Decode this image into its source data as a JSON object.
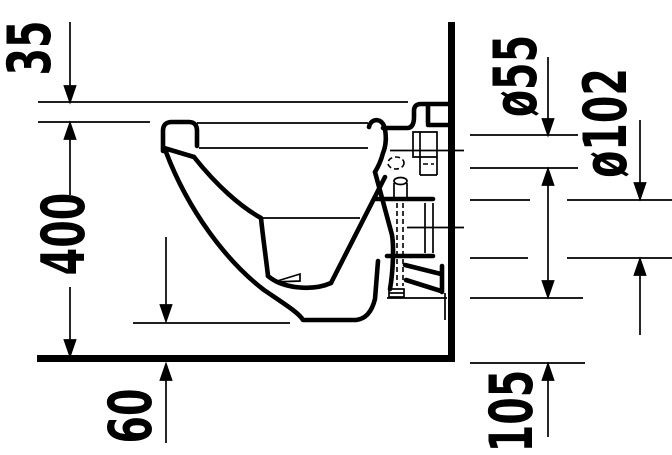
{
  "drawing": {
    "type": "technical-drawing",
    "subject": "wall-hung toilet side elevation with installation dimensions",
    "ink_color": "#000000",
    "paper_color": "#ffffff"
  },
  "labels": {
    "d35": "35",
    "d400": "400",
    "d60": "60",
    "d55": "ø55",
    "d102": "ø102",
    "d105": "105"
  }
}
